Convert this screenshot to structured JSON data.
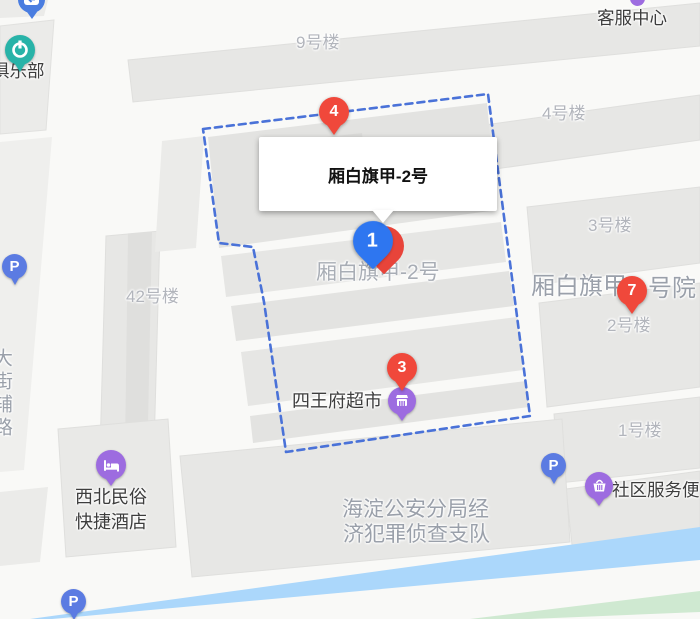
{
  "popup": {
    "title": "厢白旗甲-2号"
  },
  "markers": {
    "marker1": {
      "number": "1"
    },
    "marker3": {
      "number": "3"
    },
    "marker4": {
      "number": "4"
    },
    "marker7": {
      "number": "7"
    }
  },
  "buildings": {
    "b9": "9号楼",
    "b4": "4号楼",
    "b3": "3号楼",
    "b2": "2号楼",
    "b1": "1号楼",
    "b42": "42号楼"
  },
  "area_labels": {
    "compound_gray": "厢白旗甲-2号",
    "courtyard_left": "厢白旗甲",
    "courtyard_right": "号院",
    "police_line1": "海淀公安分局经",
    "police_line2": "济犯罪侦查支队",
    "street_vertical": "大街辅路"
  },
  "pois": {
    "customer_service": "客服中心",
    "club": "俱乐部",
    "supermarket": "四王府超市",
    "hotel_line1": "西北民俗",
    "hotel_line2": "快捷酒店",
    "community": "社区服务便",
    "parking": "P"
  },
  "colors": {
    "marker_red": "#f0483b",
    "marker_blue": "#2e76f0",
    "poi_purple": "#9d6ce0",
    "parking_blue": "#5b7be2",
    "metro_teal": "#28b3a8",
    "boundary_blue": "#4a72d8",
    "river_blue": "#abd7fb",
    "green_area": "#cfe9d1"
  }
}
